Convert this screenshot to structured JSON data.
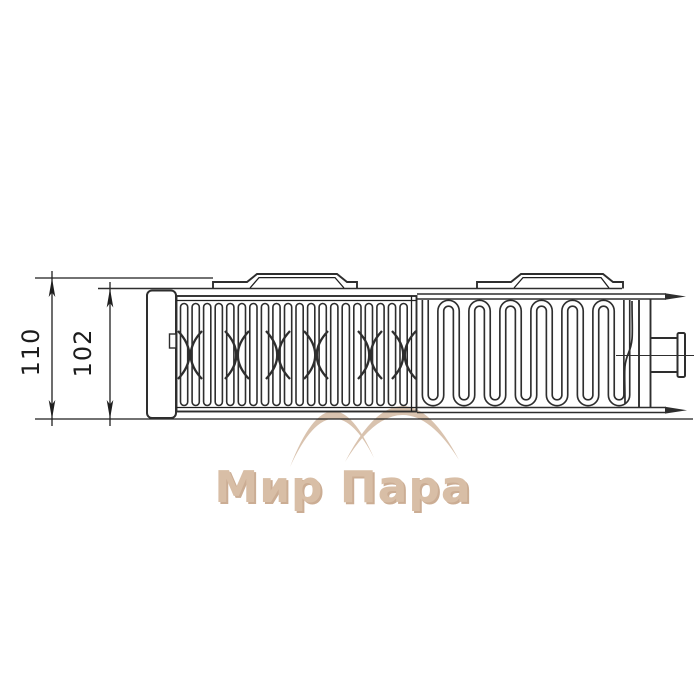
{
  "diagram": {
    "title": "panel radiator top view technical drawing",
    "dimensions": {
      "overall_depth": "110",
      "panel_depth": "102"
    },
    "watermark": {
      "text": "Мир Пара"
    },
    "colors": {
      "line": "#2e2e2e",
      "dimension_line": "#1f1f1f",
      "watermark_arc": "#d8c0ab",
      "watermark_text": "#d6bba2",
      "watermark_shadow": "#c9a98f",
      "background": "#ffffff"
    }
  }
}
